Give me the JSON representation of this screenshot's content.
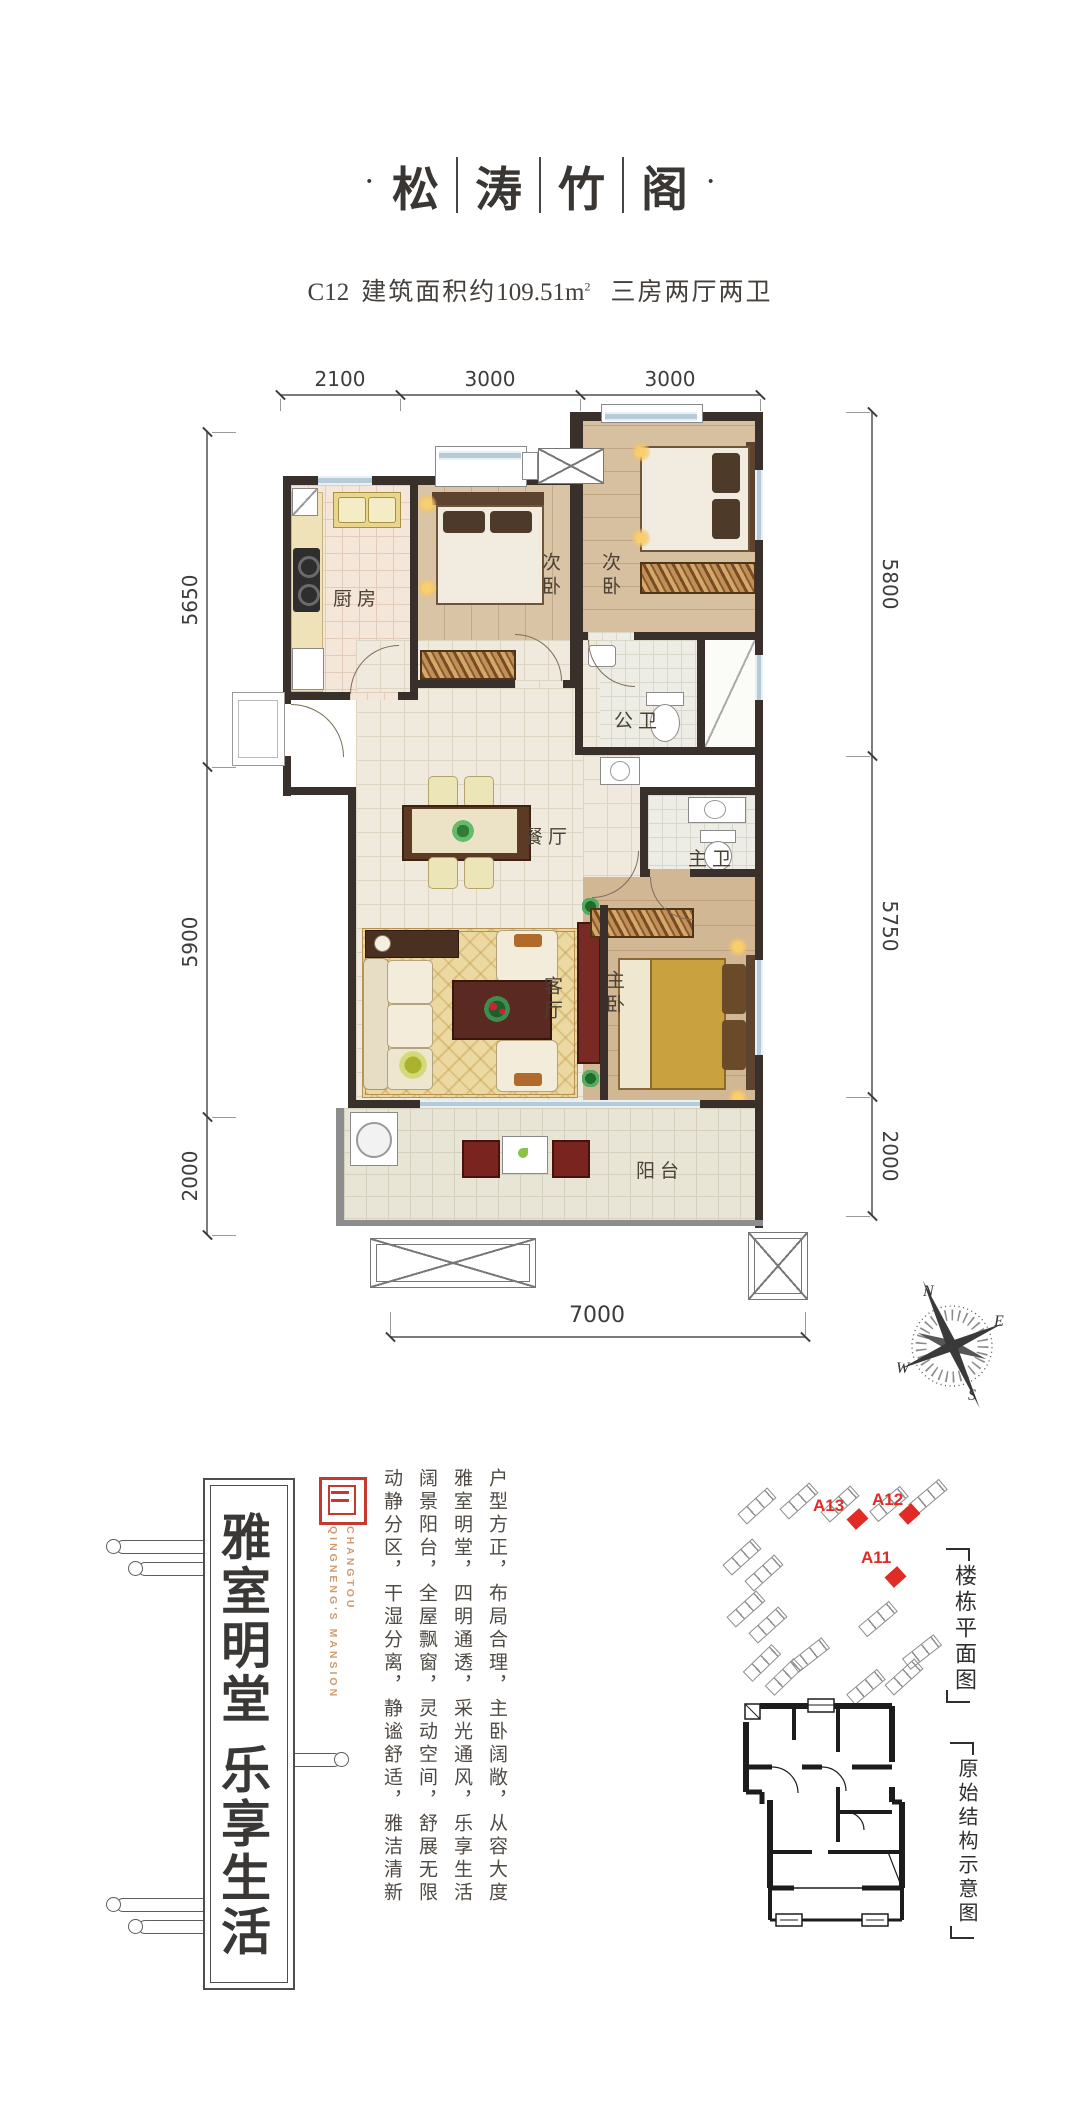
{
  "title": {
    "dot": "·",
    "chars": [
      "松",
      "涛",
      "竹",
      "阁"
    ]
  },
  "subtitle": {
    "code": "C12",
    "area_label": "建筑面积约",
    "area_value": "109.51",
    "area_unit": "m",
    "area_sup": "2",
    "layout": "三房两厅两卫"
  },
  "dims": {
    "top": [
      "2100",
      "3000",
      "3000"
    ],
    "left": [
      "5650",
      "5900",
      "2000"
    ],
    "right": [
      "5800",
      "5750",
      "2000"
    ],
    "bottom": "7000"
  },
  "rooms": {
    "kitchen": "厨房",
    "bedroom_a": "次卧",
    "bedroom_b": "次卧",
    "public_bath": "公卫",
    "dining": "餐厅",
    "master_bath": "主卫",
    "living": "客厅",
    "master_bedroom": "主卧",
    "balcony": "阳台"
  },
  "compass": {
    "n": "N",
    "e": "E",
    "s": "S",
    "w": "W"
  },
  "banner": {
    "text": "雅室明堂 乐享生活"
  },
  "seal": {
    "line1": "CHANGTOU",
    "line2": "QINGNENG'S MANSION"
  },
  "slogans": [
    "户型方正，布局合理，主卧阔敞，从容大度",
    "雅室明堂，四明通透，采光通风，乐享生活",
    "阔景阳台，全屋飘窗，灵动空间，舒展无限",
    "动静分区，干湿分离，静谧舒适，雅洁清新"
  ],
  "site_plan": {
    "units": [
      {
        "label": "A13"
      },
      {
        "label": "A12"
      },
      {
        "label": "A11"
      }
    ],
    "caption": "楼栋平面图"
  },
  "structure_diagram": {
    "caption": "原始结构示意图"
  },
  "colors": {
    "accent_red": "#e02b26",
    "seal_red": "#c43a2e",
    "wall": "#3a302b",
    "window_blue": "#b5cbd8",
    "seal_text_orange": "#d09b6e"
  }
}
